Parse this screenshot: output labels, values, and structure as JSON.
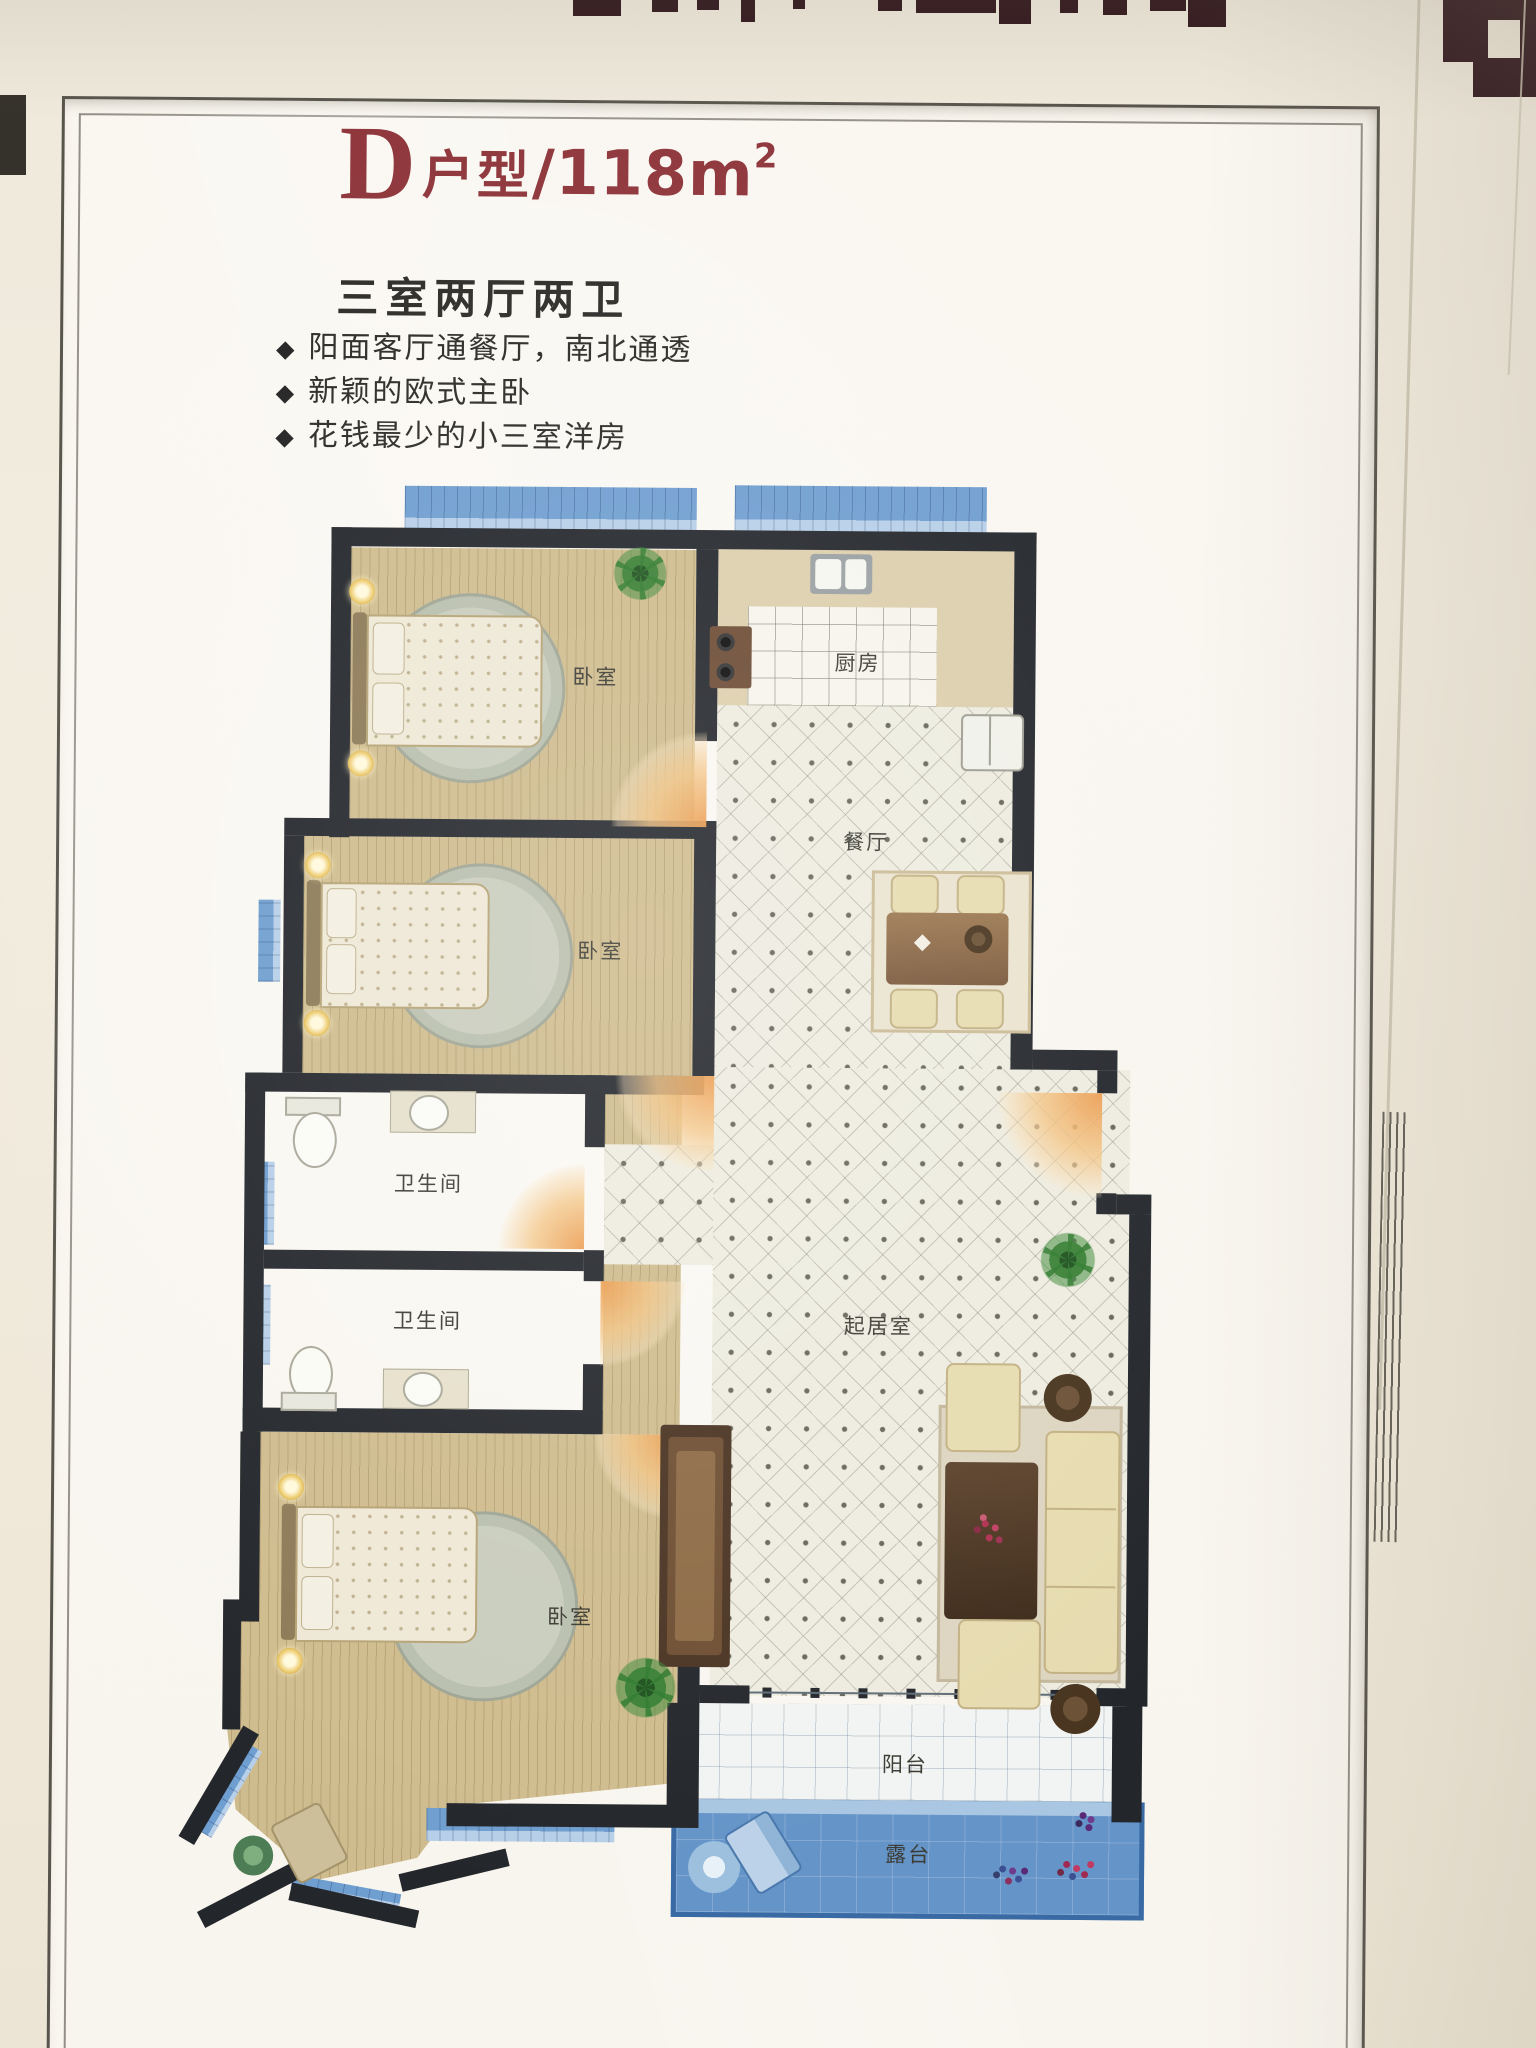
{
  "poster": {
    "unit_letter": "D",
    "unit_type_label": "户型",
    "area_value": "/118m",
    "area_exponent": "2",
    "layout_summary": "三室两厅两卫",
    "bullet_glyph": "◆",
    "features": [
      "阳面客厅通餐厅，南北通透",
      "新颖的欧式主卧",
      "花钱最少的小三室洋房"
    ]
  },
  "floorplan": {
    "rooms": [
      {
        "id": "bedroom-1",
        "label": "卧室"
      },
      {
        "id": "kitchen",
        "label": "厨房"
      },
      {
        "id": "dining-room",
        "label": "餐厅"
      },
      {
        "id": "bedroom-2",
        "label": "卧室"
      },
      {
        "id": "bathroom-1",
        "label": "卫生间"
      },
      {
        "id": "bathroom-2",
        "label": "卫生间"
      },
      {
        "id": "living-room",
        "label": "起居室"
      },
      {
        "id": "bedroom-3",
        "label": "卧室"
      },
      {
        "id": "balcony",
        "label": "阳台"
      },
      {
        "id": "terrace",
        "label": "露台"
      }
    ]
  },
  "colors": {
    "title_red": "#8e353a",
    "text_dark": "#2c2b28",
    "wall_black": "#23262b",
    "wood_floor": "#cfbc8e",
    "tile_light": "#eeece0",
    "bath_tile": "#c6c6b1",
    "kitchen_tile": "#f6f4ec",
    "window_blue": "#6f9ed0",
    "window_blue_light": "#b7cfe8",
    "terrace_blue": "#6494c8",
    "terrace_rail": "#3a6aa4",
    "door_orange": "#eb9b4d",
    "frame_line": "#57544c"
  }
}
